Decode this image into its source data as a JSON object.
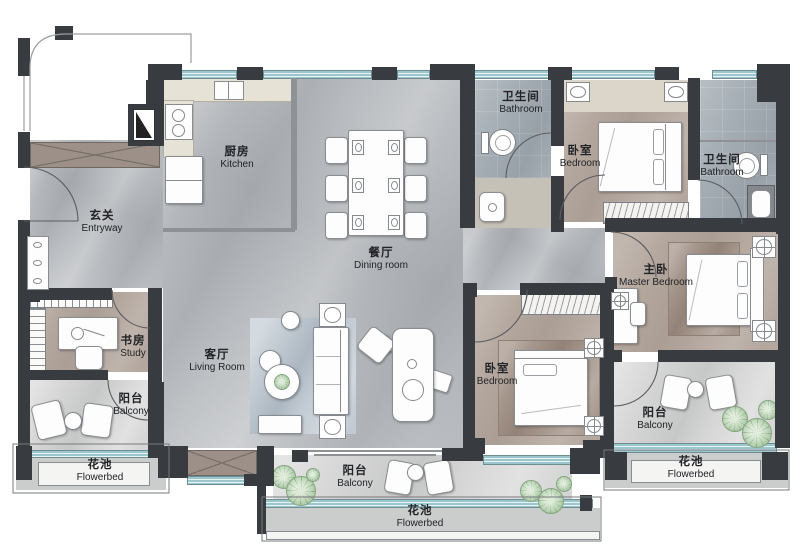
{
  "plan": {
    "title": "apartment-floor-plan",
    "rooms": [
      {
        "id": "entryway",
        "zh": "玄关",
        "en": "Entryway"
      },
      {
        "id": "kitchen",
        "zh": "厨房",
        "en": "Kitchen"
      },
      {
        "id": "dining-room",
        "zh": "餐厅",
        "en": "Dining room"
      },
      {
        "id": "living-room",
        "zh": "客厅",
        "en": "Living Room"
      },
      {
        "id": "study",
        "zh": "书房",
        "en": "Study"
      },
      {
        "id": "balcony-left",
        "zh": "阳台",
        "en": "Balcony"
      },
      {
        "id": "flowerbed-left",
        "zh": "花池",
        "en": "Flowerbed"
      },
      {
        "id": "bathroom-top",
        "zh": "卫生间",
        "en": "Bathroom"
      },
      {
        "id": "bedroom-top",
        "zh": "卧室",
        "en": "Bedroom"
      },
      {
        "id": "bathroom-right",
        "zh": "卫生间",
        "en": "Bathroom"
      },
      {
        "id": "master-bedroom",
        "zh": "主卧",
        "en": "Master Bedroom"
      },
      {
        "id": "bedroom-bottom",
        "zh": "卧室",
        "en": "Bedroom"
      },
      {
        "id": "balcony-center",
        "zh": "阳台",
        "en": "Balcony"
      },
      {
        "id": "flowerbed-center",
        "zh": "花池",
        "en": "Flowerbed"
      },
      {
        "id": "balcony-right",
        "zh": "阳台",
        "en": "Balcony"
      },
      {
        "id": "flowerbed-right",
        "zh": "花池",
        "en": "Flowerbed"
      }
    ],
    "colors": {
      "wall": "#383b40",
      "window": "#a6cdd3",
      "marble_floor": "#b8bbbf",
      "wood_floor": "#b4a79e",
      "tile_floor": "#a4adb4",
      "balcony_floor": "#d4d5d4",
      "counter": "#e7e2d6",
      "plant": "#b9d4b4",
      "closet": "#9d9089",
      "text": "#212327"
    }
  }
}
